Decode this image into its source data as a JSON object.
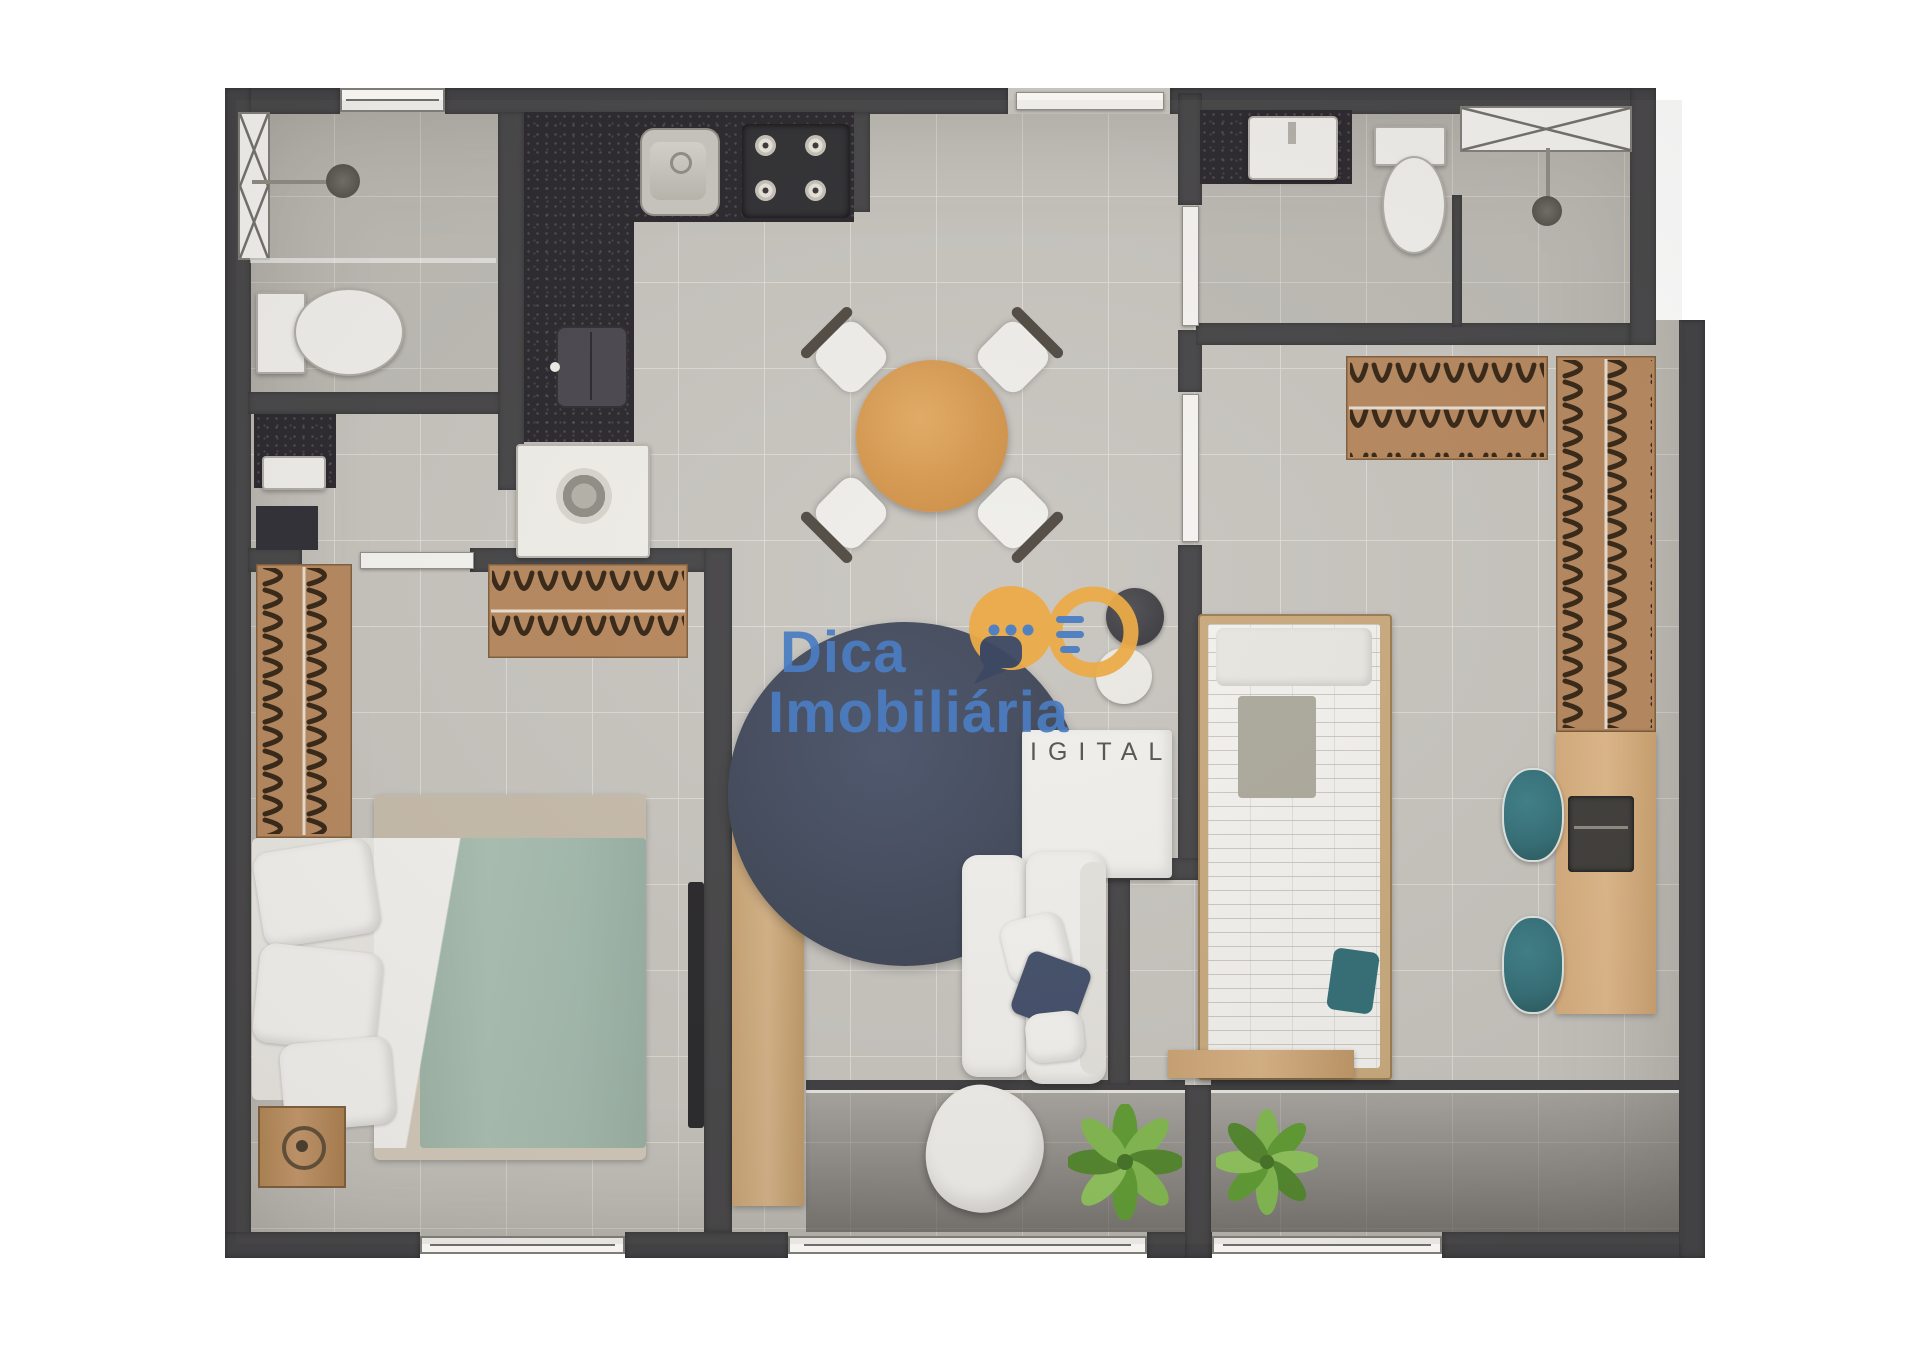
{
  "watermark": {
    "line1": "Dica",
    "line2": "Imobiliária",
    "tagline_visible": "IGITAL",
    "logo_icon": "speech-bubble-infinity-icon",
    "colors": {
      "brand_blue": "#4a7dc2",
      "brand_yellow": "#ecab47",
      "bubble_navy": "#3d4963",
      "tagline_gray": "#5a5852"
    }
  },
  "plan": {
    "rooms": [
      "bathroom-1",
      "kitchen",
      "laundry",
      "living-dining",
      "bedroom-1",
      "hall",
      "bathroom-2",
      "bedroom-2",
      "balcony"
    ],
    "palette": {
      "wall": "#424143",
      "floor": "#c7c4be",
      "tile_line": "#e0ddd7",
      "counter_granite": "#242227",
      "wardrobe_wood": "#b5855a",
      "table_wood": "#d0903f",
      "desk_wood": "#d5ab79",
      "rug_navy": "#3b4354",
      "bed_duvet_sage": "#a6bdb0",
      "chair_teal": "#2e6b74",
      "plant_green": "#5c9a2e",
      "soft_white": "#f1f0ec"
    }
  }
}
